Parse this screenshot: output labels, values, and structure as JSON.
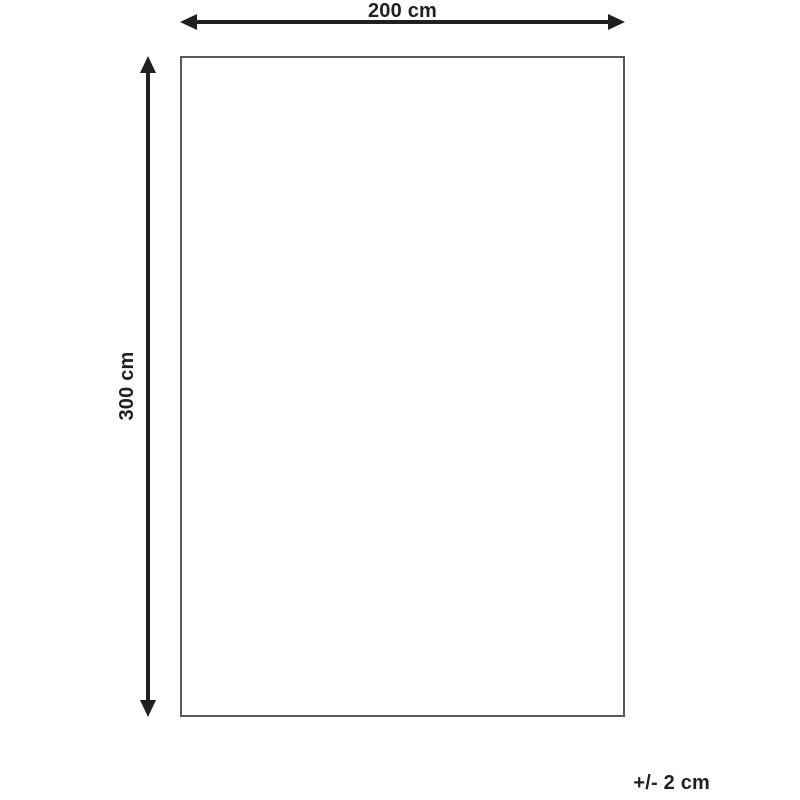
{
  "diagram": {
    "type": "product-dimension-diagram",
    "width_label": "200 cm",
    "height_label": "300 cm",
    "tolerance_label": "+/- 2 cm",
    "colors": {
      "arrow_and_text": "#231f20",
      "outline_border": "#58595b",
      "background": "#ffffff"
    }
  }
}
